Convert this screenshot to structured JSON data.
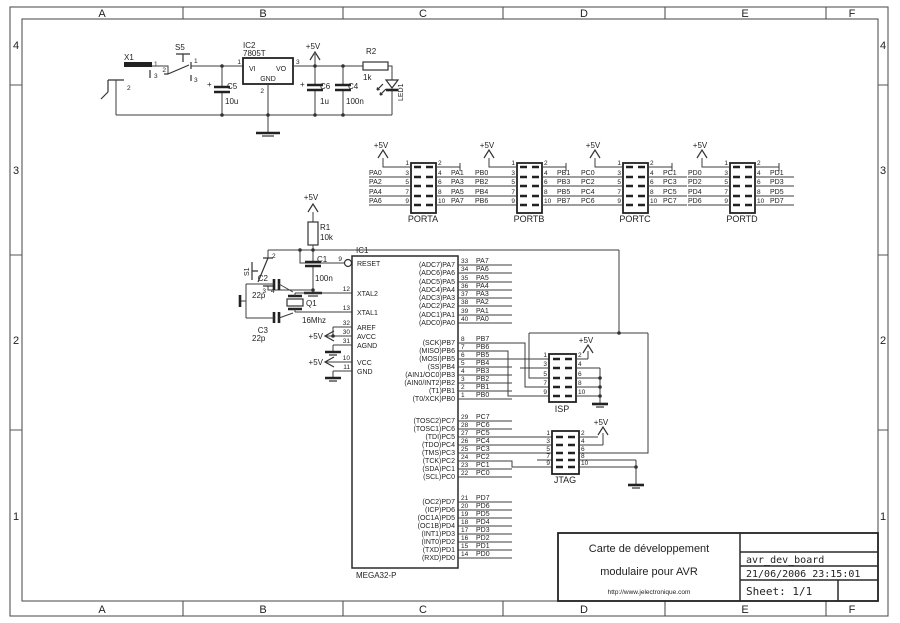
{
  "labels": {
    "p5v": "+5V",
    "plus": "+"
  },
  "frame": {
    "cols": [
      "A",
      "B",
      "C",
      "D",
      "E",
      "F"
    ],
    "rows": [
      "4",
      "3",
      "2",
      "1"
    ]
  },
  "power": {
    "x1": {
      "ref": "X1",
      "p1": "1",
      "p2": "2",
      "p3": "3"
    },
    "s5": {
      "ref": "S5",
      "p1": "1",
      "p2": "2",
      "p3": "3"
    },
    "ic2": {
      "ref": "IC2",
      "part": "7805T",
      "vi": "VI",
      "vo": "VO",
      "gnd": "GND",
      "p1": "1",
      "p2": "2",
      "p3": "3"
    },
    "c5": {
      "ref": "C5",
      "val": "10u"
    },
    "c6": {
      "ref": "C6",
      "val": "1u"
    },
    "c4": {
      "ref": "C4",
      "val": "100n"
    },
    "r2": {
      "ref": "R2",
      "val": "1k"
    },
    "led": {
      "ref": "LED1"
    }
  },
  "reset": {
    "r1": {
      "ref": "R1",
      "val": "10k"
    },
    "s1": {
      "ref": "S1",
      "p2": "2",
      "p3": "3",
      "p4": "4"
    },
    "c1": {
      "ref": "C1",
      "val": "100n"
    }
  },
  "xtal": {
    "c2": {
      "ref": "C2",
      "val": "22p"
    },
    "c3": {
      "ref": "C3",
      "val": "22p"
    },
    "q1": {
      "ref": "Q1",
      "val": "16Mhz"
    }
  },
  "mcu": {
    "ref": "IC1",
    "part": "MEGA32-P",
    "left": [
      {
        "num": "9",
        "name": "RESET"
      },
      {
        "num": "12",
        "name": "XTAL2"
      },
      {
        "num": "13",
        "name": "XTAL1"
      },
      {
        "num": "32",
        "name": "AREF"
      },
      {
        "num": "30",
        "name": "AVCC"
      },
      {
        "num": "31",
        "name": "AGND"
      },
      {
        "num": "10",
        "name": "VCC"
      },
      {
        "num": "11",
        "name": "GND"
      }
    ],
    "right": [
      {
        "inner": "(ADC7)PA7",
        "num": "33",
        "net": "PA7"
      },
      {
        "inner": "(ADC6)PA6",
        "num": "34",
        "net": "PA6"
      },
      {
        "inner": "(ADC5)PA5",
        "num": "35",
        "net": "PA5"
      },
      {
        "inner": "(ADC4)PA4",
        "num": "36",
        "net": "PA4"
      },
      {
        "inner": "(ADC3)PA3",
        "num": "37",
        "net": "PA3"
      },
      {
        "inner": "(ADC2)PA2",
        "num": "38",
        "net": "PA2"
      },
      {
        "inner": "(ADC1)PA1",
        "num": "39",
        "net": "PA1"
      },
      {
        "inner": "(ADC0)PA0",
        "num": "40",
        "net": "PA0"
      },
      {
        "inner": "(SCK)PB7",
        "num": "8",
        "net": "PB7"
      },
      {
        "inner": "(MISO)PB6",
        "num": "7",
        "net": "PB6"
      },
      {
        "inner": "(MOSI)PB5",
        "num": "6",
        "net": "PB5"
      },
      {
        "inner": "(SS)PB4",
        "num": "5",
        "net": "PB4"
      },
      {
        "inner": "(AIN1/OC0)PB3",
        "num": "4",
        "net": "PB3"
      },
      {
        "inner": "(AIN0/INT2)PB2",
        "num": "3",
        "net": "PB2"
      },
      {
        "inner": "(T1)PB1",
        "num": "2",
        "net": "PB1"
      },
      {
        "inner": "(T0/XCK)PB0",
        "num": "1",
        "net": "PB0"
      },
      {
        "inner": "(TOSC2)PC7",
        "num": "29",
        "net": "PC7"
      },
      {
        "inner": "(TOSC1)PC6",
        "num": "28",
        "net": "PC6"
      },
      {
        "inner": "(TDI)PC5",
        "num": "27",
        "net": "PC5"
      },
      {
        "inner": "(TDO)PC4",
        "num": "26",
        "net": "PC4"
      },
      {
        "inner": "(TMS)PC3",
        "num": "25",
        "net": "PC3"
      },
      {
        "inner": "(TCK)PC2",
        "num": "24",
        "net": "PC2"
      },
      {
        "inner": "(SDA)PC1",
        "num": "23",
        "net": "PC1"
      },
      {
        "inner": "(SCL)PC0",
        "num": "22",
        "net": "PC0"
      },
      {
        "inner": "(OC2)PD7",
        "num": "21",
        "net": "PD7"
      },
      {
        "inner": "(ICP)PD6",
        "num": "20",
        "net": "PD6"
      },
      {
        "inner": "(OC1A)PD5",
        "num": "19",
        "net": "PD5"
      },
      {
        "inner": "(OC1B)PD4",
        "num": "18",
        "net": "PD4"
      },
      {
        "inner": "(INT1)PD3",
        "num": "17",
        "net": "PD3"
      },
      {
        "inner": "(INT0)PD2",
        "num": "16",
        "net": "PD2"
      },
      {
        "inner": "(TXD)PD1",
        "num": "15",
        "net": "PD1"
      },
      {
        "inner": "(RXD)PD0",
        "num": "14",
        "net": "PD0"
      }
    ]
  },
  "headers": [
    {
      "name": "PORTA",
      "ln": [
        "1",
        "3",
        "5",
        "7",
        "9"
      ],
      "rn": [
        "2",
        "4",
        "6",
        "8",
        "10"
      ],
      "lnets": [
        "PA0",
        "PA2",
        "PA4",
        "PA6"
      ],
      "rnets": [
        "PA1",
        "PA3",
        "PA5",
        "PA7"
      ]
    },
    {
      "name": "PORTB",
      "ln": [
        "1",
        "3",
        "5",
        "7",
        "9"
      ],
      "rn": [
        "2",
        "4",
        "6",
        "8",
        "10"
      ],
      "lnets": [
        "PB0",
        "PB2",
        "PB4",
        "PB6"
      ],
      "rnets": [
        "PB1",
        "PB3",
        "PB5",
        "PB7"
      ]
    },
    {
      "name": "PORTC",
      "ln": [
        "1",
        "3",
        "5",
        "7",
        "9"
      ],
      "rn": [
        "2",
        "4",
        "6",
        "8",
        "10"
      ],
      "lnets": [
        "PC0",
        "PC2",
        "PC4",
        "PC6"
      ],
      "rnets": [
        "PC1",
        "PC3",
        "PC5",
        "PC7"
      ]
    },
    {
      "name": "PORTD",
      "ln": [
        "1",
        "3",
        "5",
        "7",
        "9"
      ],
      "rn": [
        "2",
        "4",
        "6",
        "8",
        "10"
      ],
      "lnets": [
        "PD0",
        "PD2",
        "PD4",
        "PD6"
      ],
      "rnets": [
        "PD1",
        "PD3",
        "PD5",
        "PD7"
      ]
    }
  ],
  "isp": {
    "name": "ISP",
    "ln": [
      "1",
      "3",
      "5",
      "7",
      "9"
    ],
    "rn": [
      "2",
      "4",
      "6",
      "8",
      "10"
    ]
  },
  "jtag": {
    "name": "JTAG",
    "ln": [
      "1",
      "3",
      "5",
      "7",
      "9"
    ],
    "rn": [
      "2",
      "4",
      "6",
      "8",
      "10"
    ]
  },
  "titleblock": {
    "title1": "Carte de développement",
    "title2": "modulaire pour AVR",
    "url": "http://www.jelectronique.com",
    "project": "avr_dev_board",
    "datetime": "21/06/2006 23:15:01",
    "sheet": "Sheet: 1/1"
  }
}
